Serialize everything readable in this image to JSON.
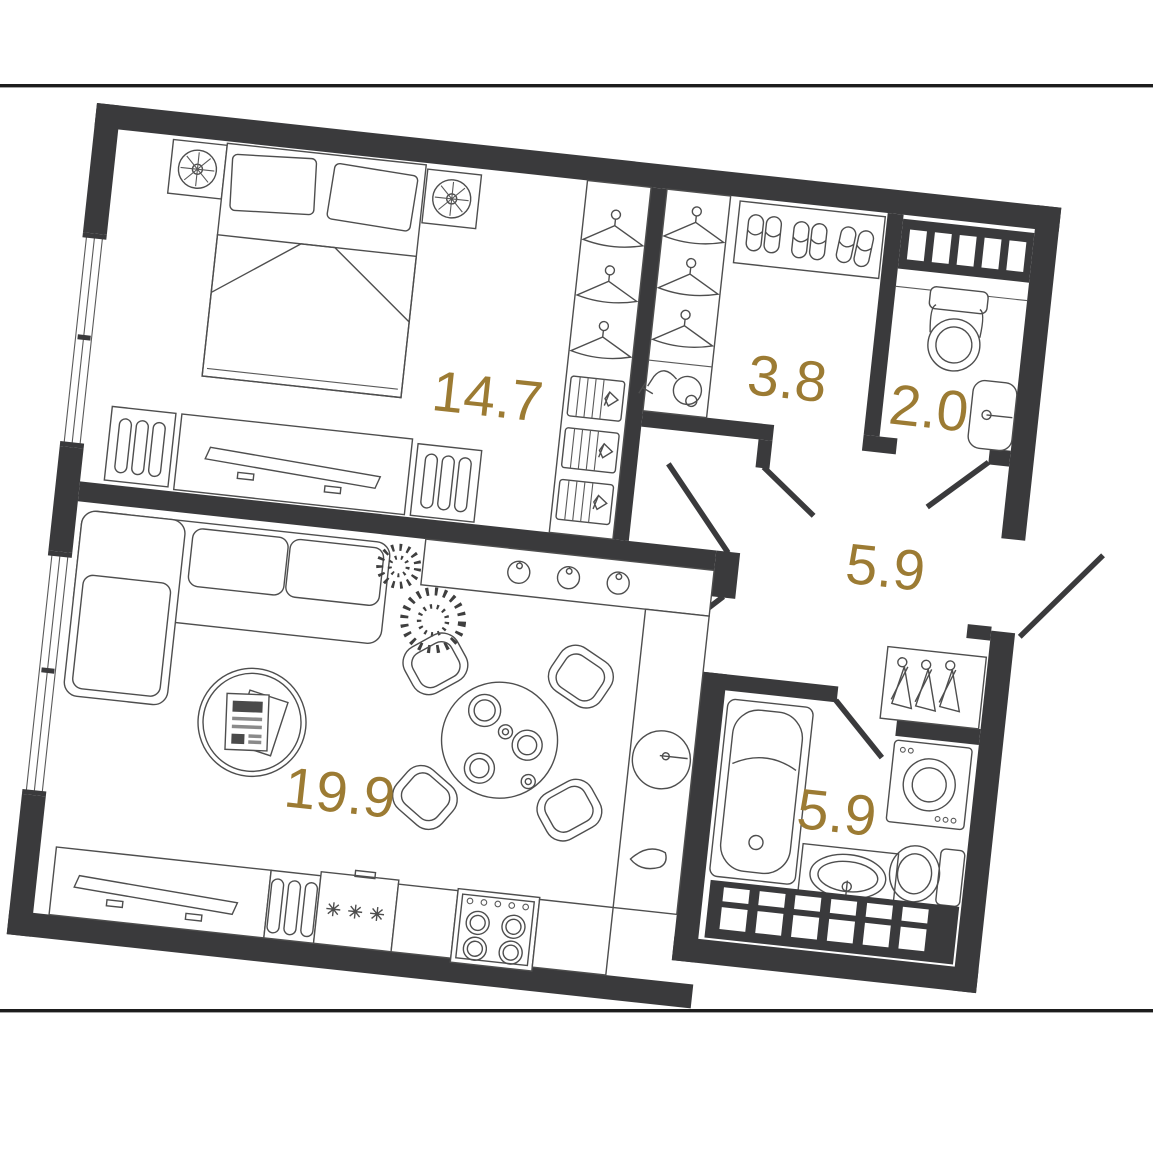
{
  "plan_type": "apartment-floor-plan",
  "colors": {
    "walls": "#3a3a3c",
    "furniture_lines": "#4e4e4e",
    "area_labels": "#9c7b33",
    "background": "#ffffff"
  },
  "rooms": [
    {
      "name": "bedroom",
      "area": "14.7"
    },
    {
      "name": "wardrobe",
      "area": "3.8"
    },
    {
      "name": "wc",
      "area": "2.0"
    },
    {
      "name": "hallway",
      "area": "5.9"
    },
    {
      "name": "living-room-kitchen",
      "area": "19.9"
    },
    {
      "name": "bathroom",
      "area": "5.9"
    }
  ],
  "icons": [
    "bed",
    "pillow",
    "table-lamp",
    "wardrobe-hanger",
    "folded-clothes",
    "slippers",
    "vacuum-cleaner",
    "towel-radiator",
    "toilet",
    "wash-basin",
    "bathtub",
    "washing-machine",
    "coat-hanger",
    "sofa",
    "potted-plant",
    "coffee-table",
    "magazine",
    "dining-table",
    "dining-chair",
    "plate",
    "hob-knob",
    "kitchen-sink",
    "water-drop",
    "radiator",
    "fridge-snowflake",
    "stove-burner",
    "window",
    "door-swing"
  ]
}
